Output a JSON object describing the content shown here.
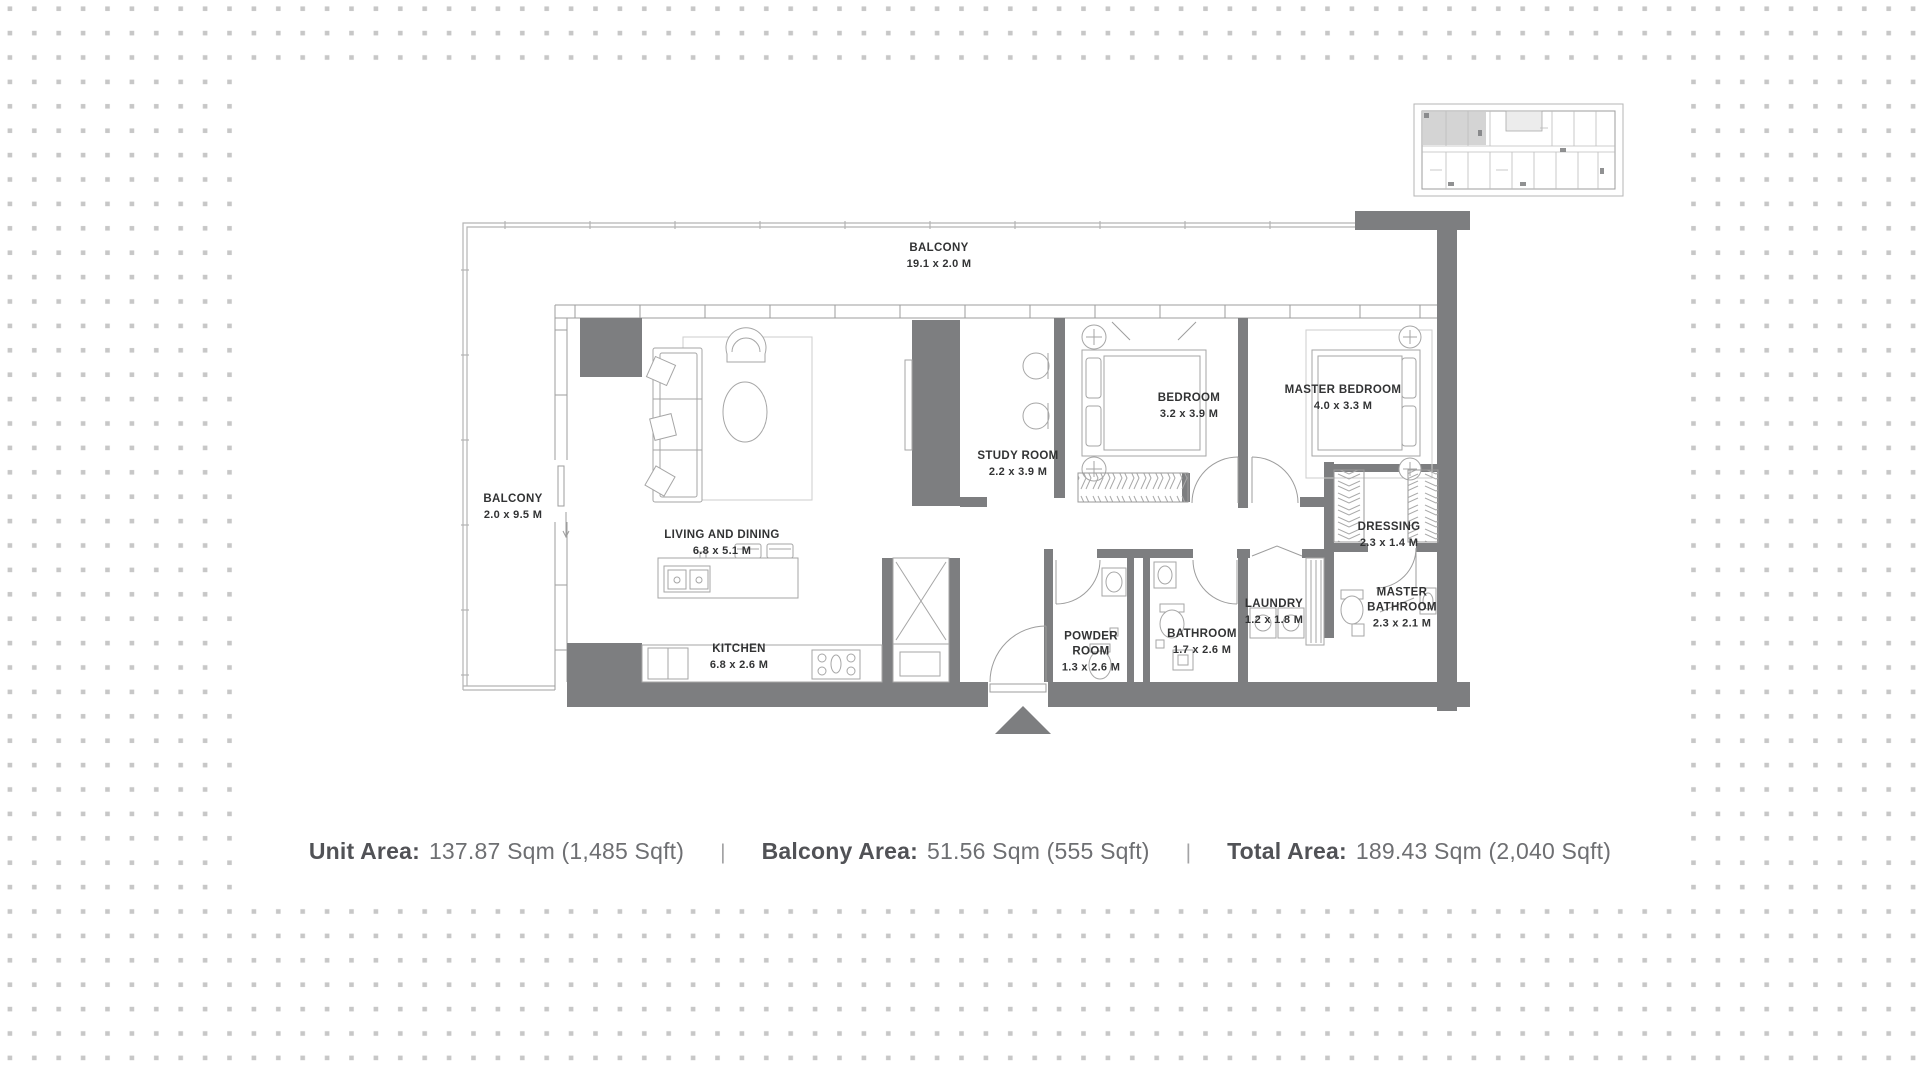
{
  "rooms": {
    "balcony_top": {
      "name": "BALCONY",
      "dims": "19.1 x 2.0 M"
    },
    "balcony_left": {
      "name": "BALCONY",
      "dims": "2.0 x 9.5 M"
    },
    "living_dining": {
      "name": "LIVING AND DINING",
      "dims": "6.8 x 5.1 M"
    },
    "kitchen": {
      "name": "KITCHEN",
      "dims": "6.8 x 2.6 M"
    },
    "study_room": {
      "name": "STUDY ROOM",
      "dims": "2.2 x 3.9 M"
    },
    "bedroom": {
      "name": "BEDROOM",
      "dims": "3.2 x 3.9 M"
    },
    "master_bedroom": {
      "name": "MASTER BEDROOM",
      "dims": "4.0 x 3.3 M"
    },
    "dressing": {
      "name": "DRESSING",
      "dims": "2.3 x 1.4 M"
    },
    "laundry": {
      "name": "LAUNDRY",
      "dims": "1.2 x 1.8 M"
    },
    "master_bathroom": {
      "name": "MASTER BATHROOM",
      "dims": "2.3 x 2.1 M"
    },
    "powder_room": {
      "name": "POWDER ROOM",
      "dims": "1.3 x 2.6 M"
    },
    "bathroom": {
      "name": "BATHROOM",
      "dims": "1.7 x 2.6 M"
    }
  },
  "stats": {
    "unit_area": {
      "label": "Unit Area:",
      "value": "137.87 Sqm (1,485 Sqft)"
    },
    "balcony_area": {
      "label": "Balcony Area:",
      "value": "51.56 Sqm (555 Sqft)"
    },
    "total_area": {
      "label": "Total Area:",
      "value": "189.43 Sqm (2,040 Sqft)"
    },
    "separator": "|"
  },
  "colors": {
    "wall": "#7d7e80",
    "furniture_line": "#a6a6a6",
    "dot_grid": "#c7c7c7",
    "label_text": "#323334",
    "stats_label": "#515256",
    "stats_value": "#6e6f72"
  }
}
